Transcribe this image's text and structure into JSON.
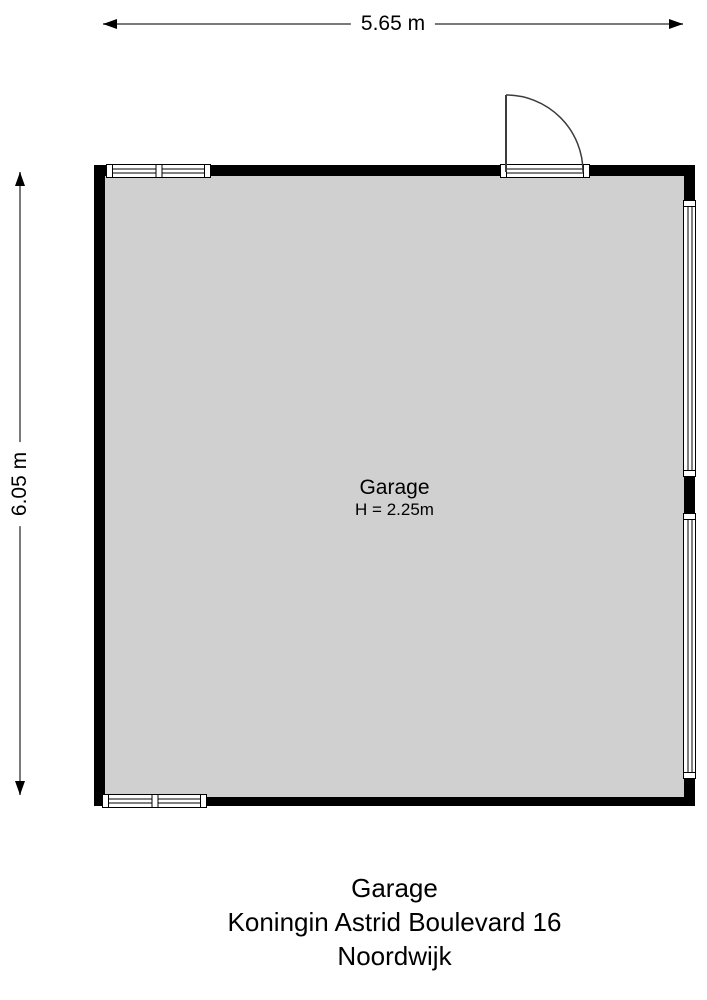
{
  "dimensions": {
    "width": {
      "label": "5.65 m"
    },
    "height": {
      "label": "6.05 m"
    }
  },
  "room": {
    "name": "Garage",
    "height_label": "H = 2.25m"
  },
  "caption": {
    "title": "Garage",
    "address": "Koningin Astrid Boulevard 16",
    "city": "Noordwijk"
  },
  "colors": {
    "background": "#ffffff",
    "wall": "#000000",
    "floor": "#d0d0d0",
    "dimension_line": "#7a7a7a",
    "door_line": "#3c3c3c",
    "text": "#000000"
  }
}
